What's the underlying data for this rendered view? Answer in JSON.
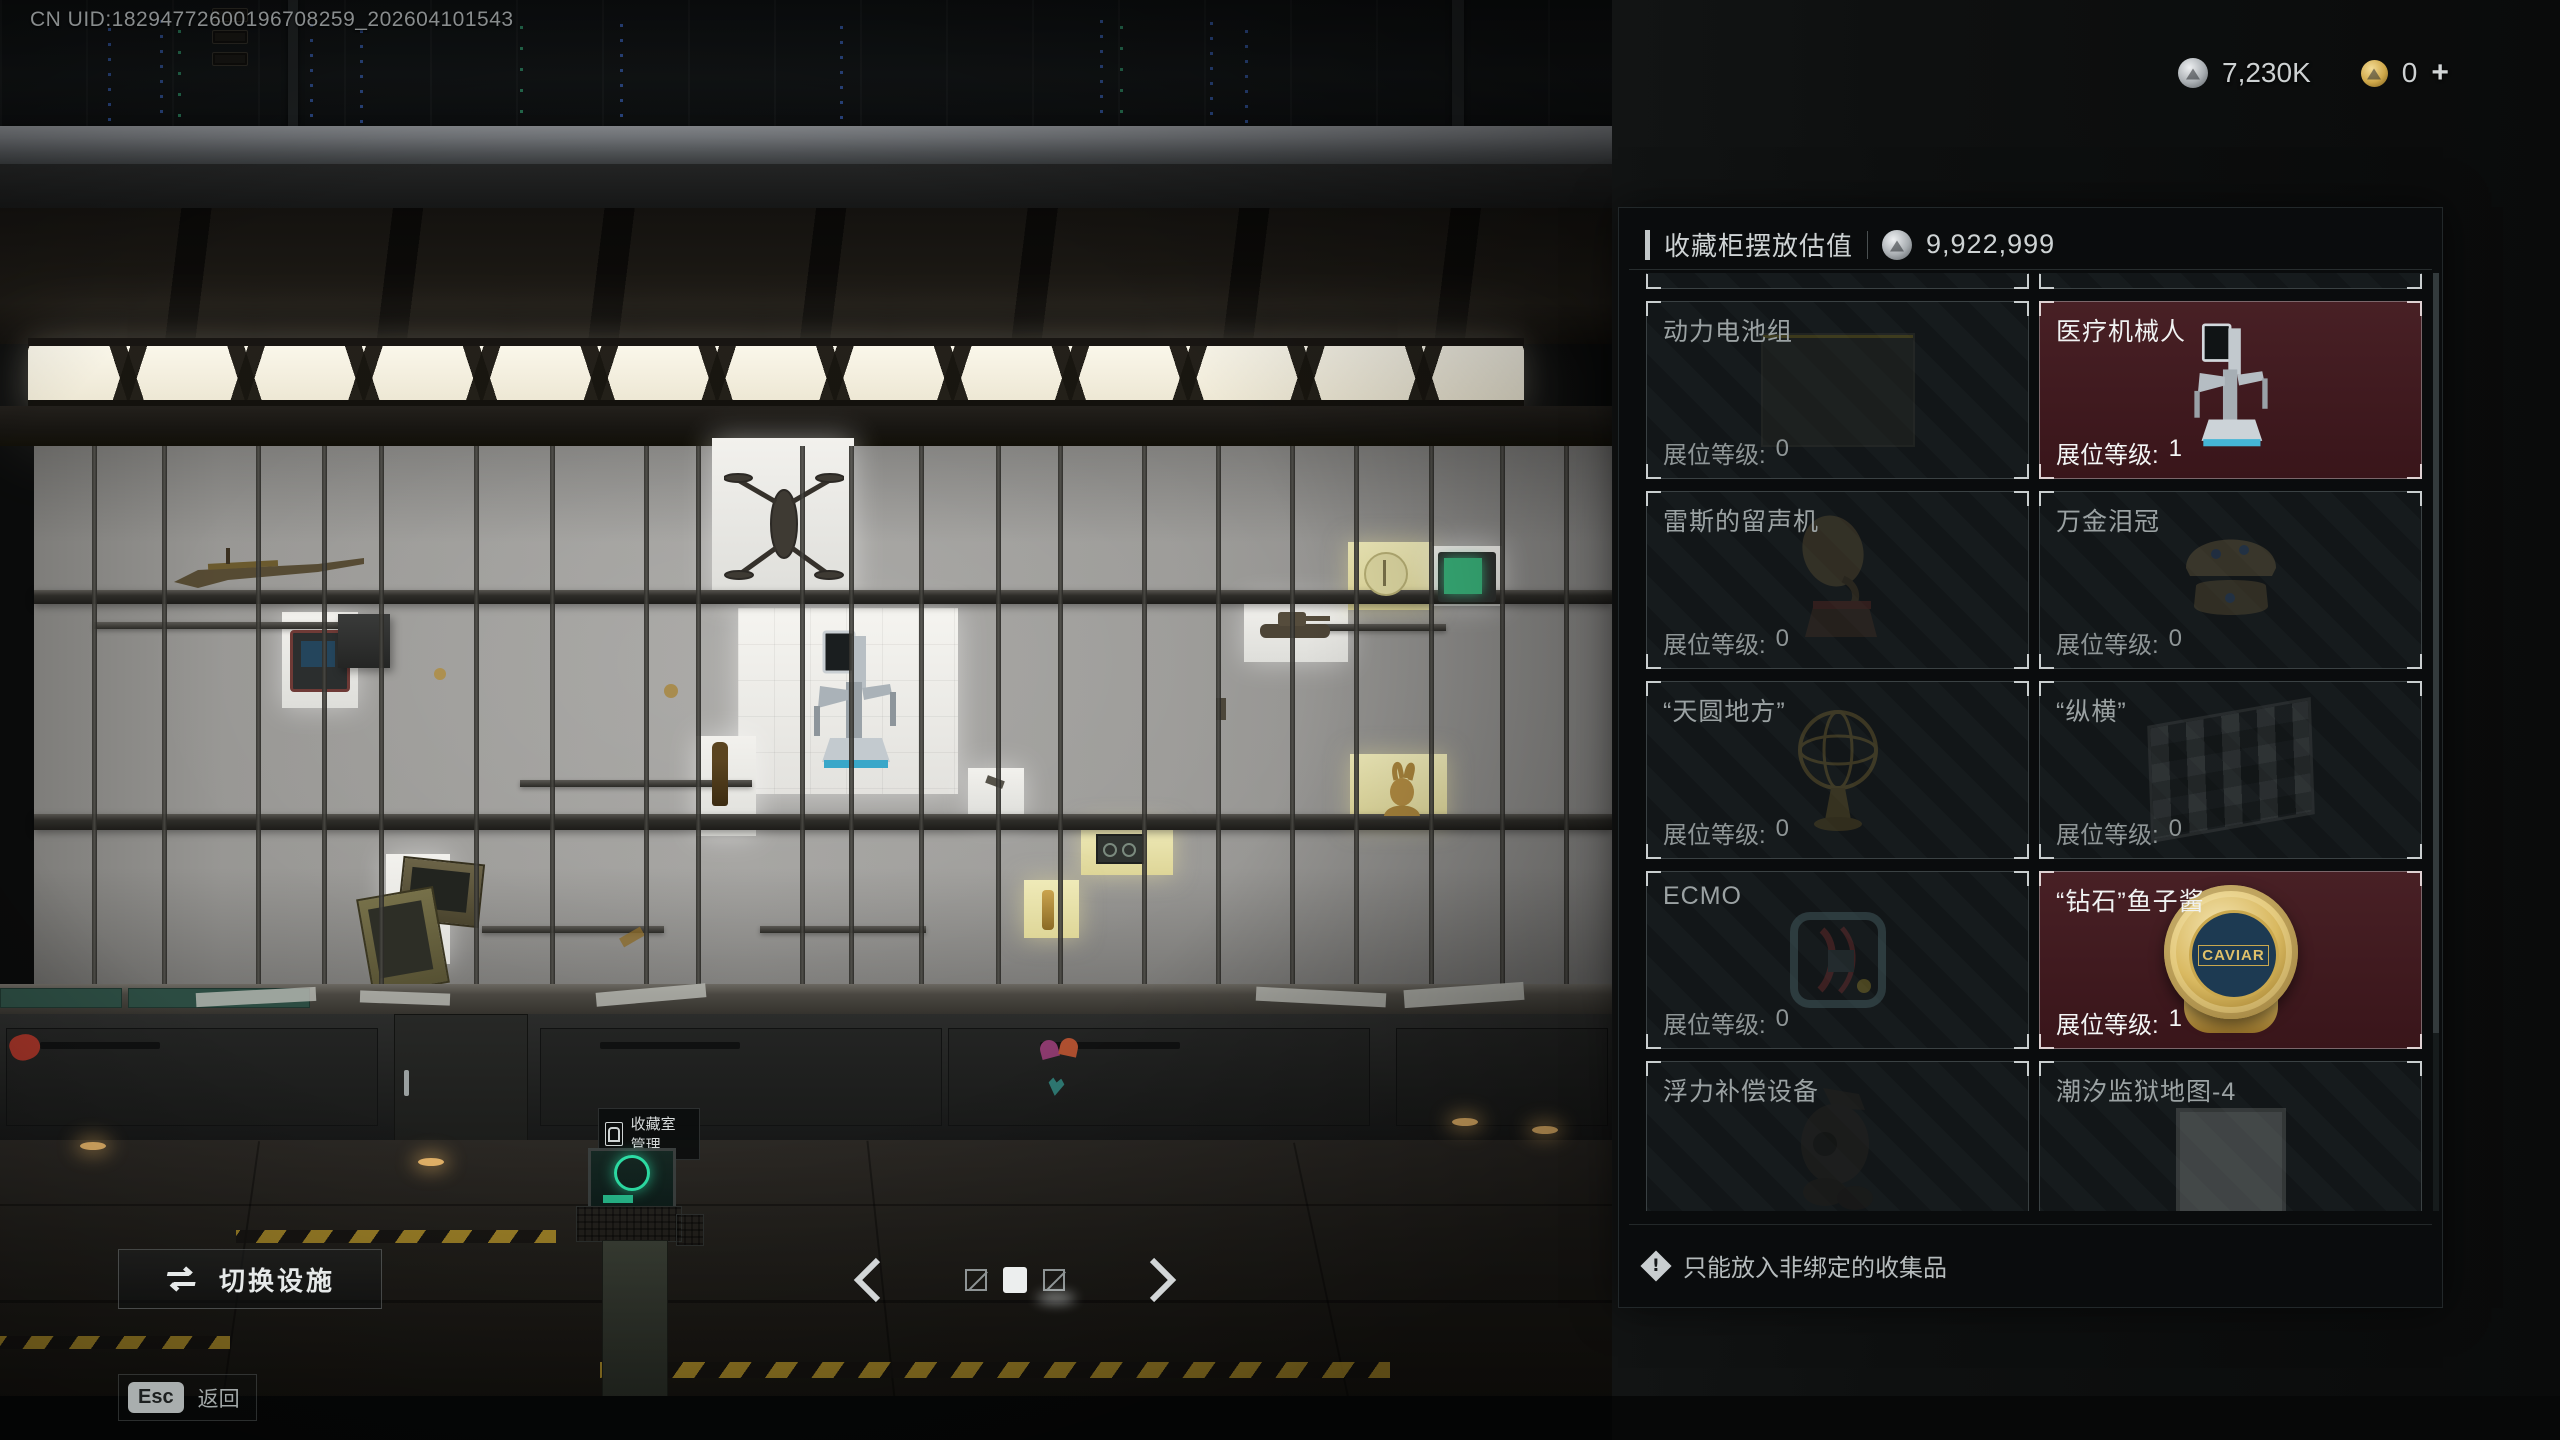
{
  "hud": {
    "uid_text": "CN UID:18294772600196708259_202604101543",
    "currencies": {
      "silver": {
        "icon": "silver-coin-icon",
        "amount": "7,230K"
      },
      "gold": {
        "icon": "gold-coin-icon",
        "amount": "0",
        "add_label": "+"
      }
    }
  },
  "panel": {
    "title": "收藏柜摆放估值",
    "value_icon": "silver-coin-icon",
    "total_value": "9,922,999",
    "slot_level_label": "展位等级:",
    "items": [
      {
        "name": "动力电池组",
        "slot_level": "0",
        "state": "dim",
        "image": "battery-pack"
      },
      {
        "name": "医疗机械人",
        "slot_level": "1",
        "state": "placed",
        "image": "medical-robot"
      },
      {
        "name": "雷斯的留声机",
        "slot_level": "0",
        "state": "dim",
        "image": "phonograph"
      },
      {
        "name": "万金泪冠",
        "slot_level": "0",
        "state": "dim",
        "image": "jeweled-crown"
      },
      {
        "name": "“天圆地方”",
        "slot_level": "0",
        "state": "dim",
        "image": "armillary-sphere"
      },
      {
        "name": "“纵横”",
        "slot_level": "0",
        "state": "dim",
        "image": "chessboard"
      },
      {
        "name": "ECMO",
        "slot_level": "0",
        "state": "dim",
        "image": "ecmo-machine"
      },
      {
        "name": "“钻石”鱼子酱",
        "slot_level": "1",
        "state": "placed",
        "image": "caviar-tin",
        "image_label": "CAVIAR"
      },
      {
        "name": "浮力补偿设备",
        "state": "dim",
        "image": "buoyancy-device",
        "cut_off": true
      },
      {
        "name": "潮汐监狱地图-4",
        "state": "dim",
        "image": "prison-map",
        "cut_off": true
      }
    ],
    "notice": "只能放入非绑定的收集品"
  },
  "scene": {
    "terminal_label": "收藏室管理"
  },
  "footer": {
    "switch_facility_label": "切换设施",
    "esc_key_label": "Esc",
    "back_label": "返回",
    "pager": {
      "total": 3,
      "active": 2
    }
  },
  "colors": {
    "placed_cell_bg": "#431c21",
    "panel_bg": "#0b0e0f",
    "accent_text": "#ced3d4",
    "warm_light": "#fbf8ec",
    "terminal_green": "#2ddfa6",
    "caviar_gold": "#d9b961"
  }
}
